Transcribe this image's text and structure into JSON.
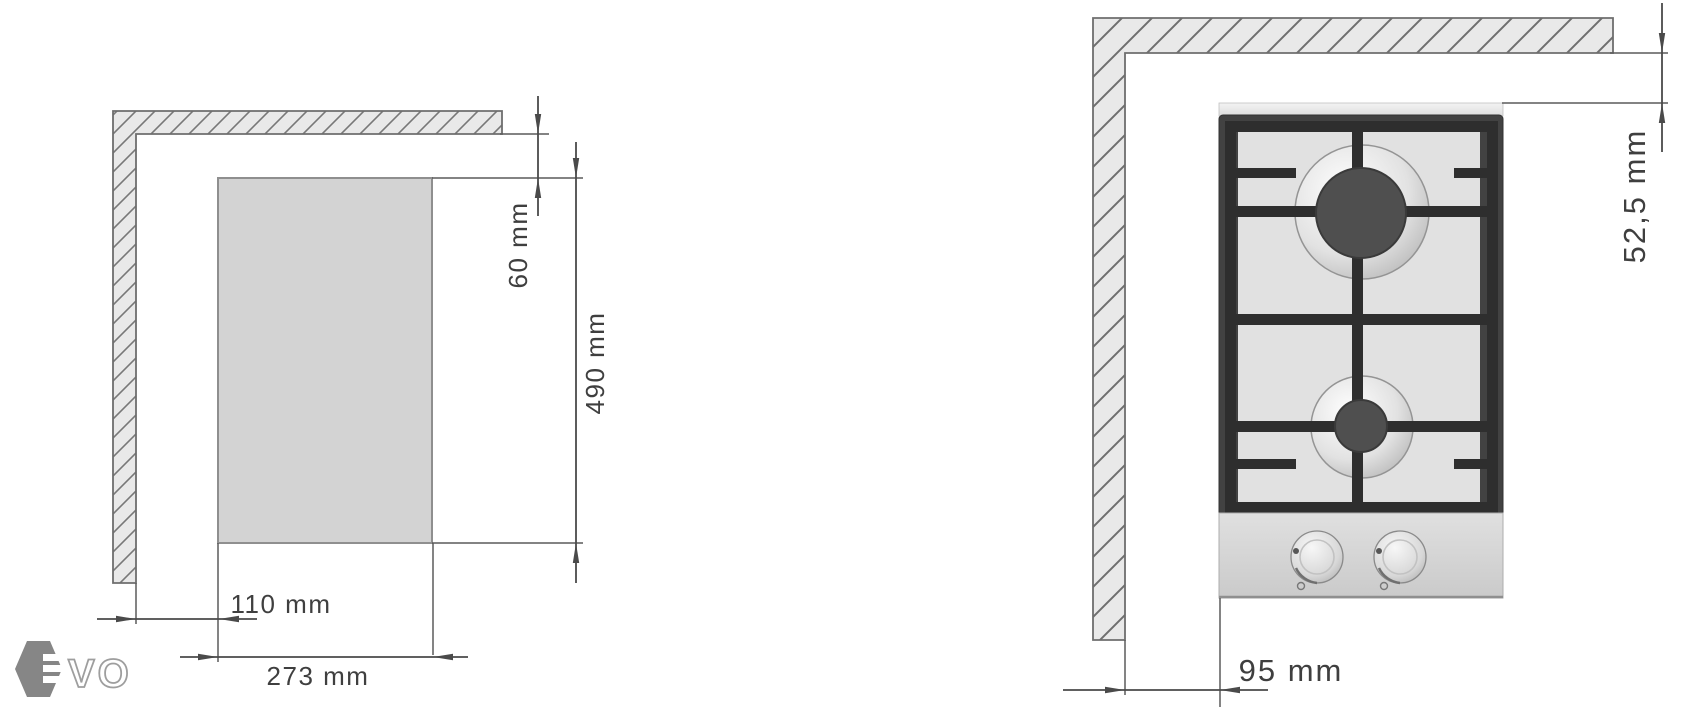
{
  "colors": {
    "dimension_line": "#4a4a4a",
    "label_text": "#3f3f3f",
    "wall_outline": "#6e6e6e",
    "hatch_fill": "#e9e9e9",
    "hatch_line": "#787878",
    "cutout_fill": "#d3d3d3",
    "cutout_border": "#8f8f8f",
    "hob_frame": "#424242",
    "hob_panel": "#e1e1e1",
    "grid_bar": "#2e2e2e",
    "burner_center": "#4f4f4f",
    "control_panel": "#d6d6d6",
    "logo_gray": "#868686"
  },
  "left_diagram": {
    "labels": {
      "side_offset": "110 mm",
      "cutout_width": "273 mm",
      "rear_offset": "60 mm",
      "cutout_depth": "490 mm"
    }
  },
  "right_diagram": {
    "labels": {
      "rear_clearance": "52,5 mm",
      "side_clearance": "95 mm"
    }
  },
  "logo": {
    "brand": "EVO",
    "wordmark": "VO"
  }
}
